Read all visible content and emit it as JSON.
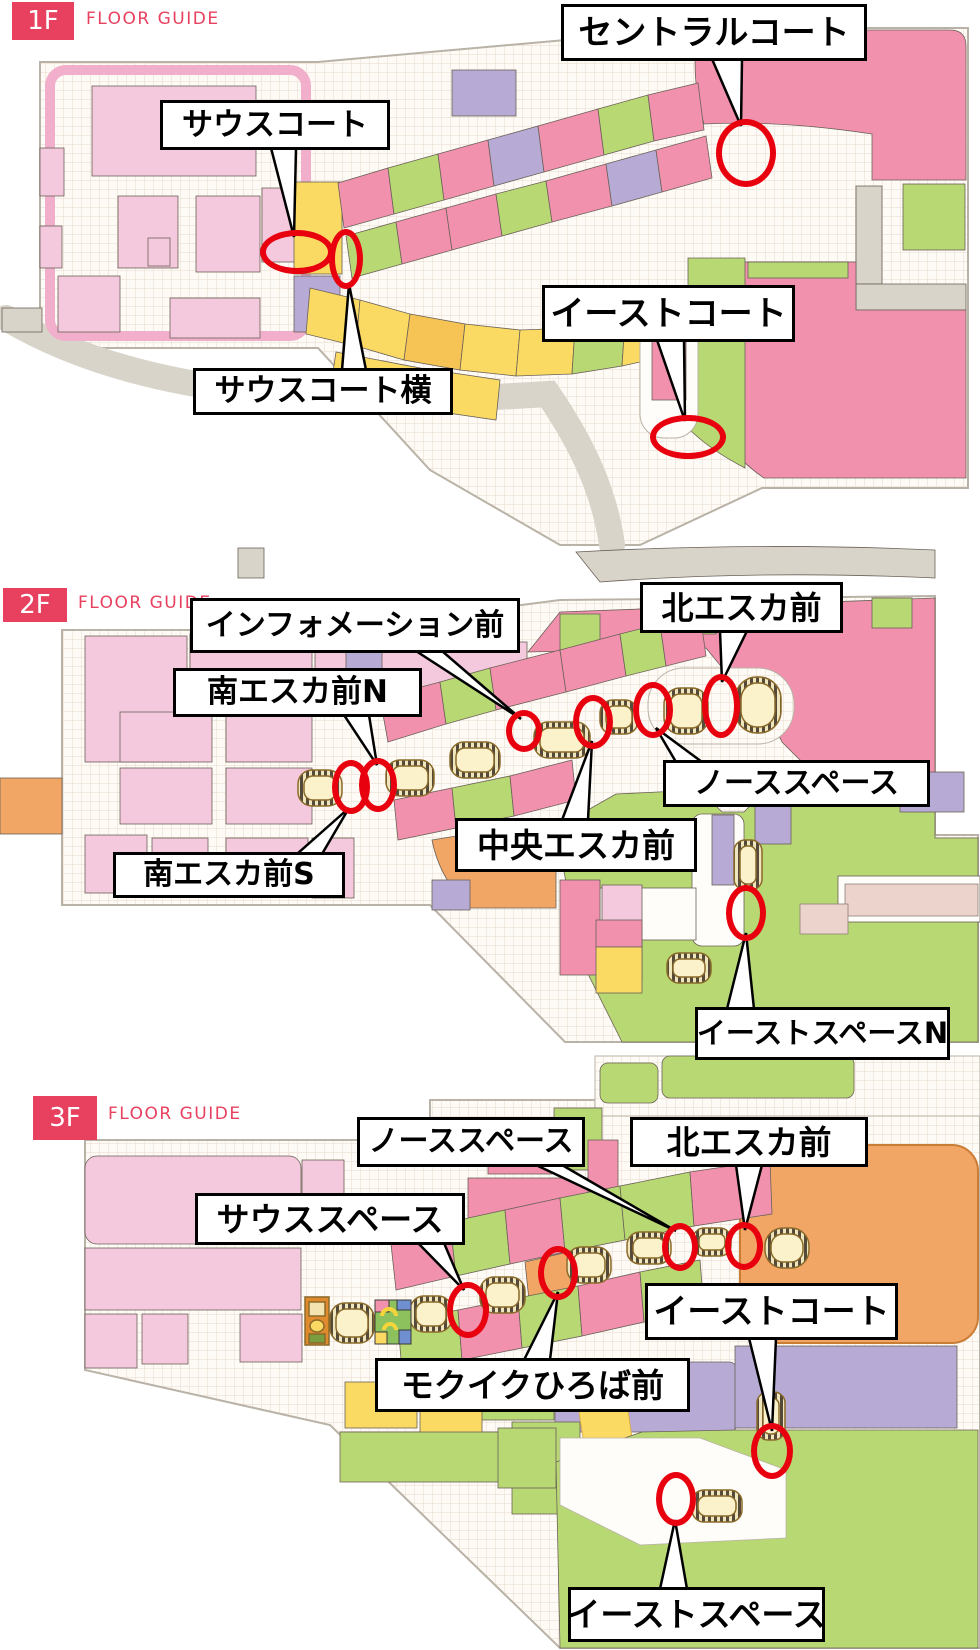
{
  "page": {
    "title": "FLOOR GUIDE"
  },
  "colors": {
    "badge_red": "#e8415f",
    "marker_red": "#e8000f",
    "shop_pink": "#f191ad",
    "light_pink": "#f4c9de",
    "shop_green": "#b8d873",
    "shop_yellow": "#fada62",
    "shop_orange": "#f2a666",
    "shop_purple": "#b7abd5",
    "escalator_cream": "#fbf2cc",
    "road_gray": "#d8d4c9"
  },
  "floors": [
    {
      "badge": "1F",
      "guide_label": "FLOOR GUIDE",
      "callouts": [
        {
          "id": "south-court",
          "label": "サウスコート"
        },
        {
          "id": "central-court",
          "label": "セントラルコート"
        },
        {
          "id": "east-court",
          "label": "イーストコート"
        },
        {
          "id": "south-court-side",
          "label": "サウスコート横"
        }
      ],
      "markers": [
        {
          "id": "south-court",
          "cx": 297,
          "cy": 252,
          "rx": 31,
          "ry": 16
        },
        {
          "id": "south-court-side",
          "cx": 346,
          "cy": 259,
          "rx": 11,
          "ry": 24
        },
        {
          "id": "central-court",
          "cx": 746,
          "cy": 153,
          "rx": 24,
          "ry": 28
        },
        {
          "id": "east-court",
          "cx": 688,
          "cy": 437,
          "rx": 32,
          "ry": 16
        }
      ]
    },
    {
      "badge": "2F",
      "guide_label": "FLOOR GUIDE",
      "callouts": [
        {
          "id": "information-front",
          "label": "インフォメーション前"
        },
        {
          "id": "north-esca-front",
          "label": "北エスカ前"
        },
        {
          "id": "south-esca-front-n",
          "label": "南エスカ前N"
        },
        {
          "id": "north-space",
          "label": "ノーススペース"
        },
        {
          "id": "central-esca-front",
          "label": "中央エスカ前"
        },
        {
          "id": "south-esca-front-s",
          "label": "南エスカ前S"
        },
        {
          "id": "east-space-n",
          "label": "イーストスペースN"
        }
      ],
      "markers": [
        {
          "id": "south-esca-front-s",
          "cx": 351,
          "cy": 787,
          "rx": 13,
          "ry": 21
        },
        {
          "id": "south-esca-front-n",
          "cx": 378,
          "cy": 785,
          "rx": 13,
          "ry": 21
        },
        {
          "id": "information-front",
          "cx": 524,
          "cy": 731,
          "rx": 12,
          "ry": 15
        },
        {
          "id": "central-esca-front",
          "cx": 593,
          "cy": 722,
          "rx": 14,
          "ry": 21
        },
        {
          "id": "north-space",
          "cx": 653,
          "cy": 710,
          "rx": 14,
          "ry": 22
        },
        {
          "id": "north-esca-front",
          "cx": 721,
          "cy": 706,
          "rx": 13,
          "ry": 26
        },
        {
          "id": "east-space-n",
          "cx": 746,
          "cy": 913,
          "rx": 14,
          "ry": 22
        }
      ]
    },
    {
      "badge": "3F",
      "guide_label": "FLOOR GUIDE",
      "callouts": [
        {
          "id": "north-space",
          "label": "ノーススペース"
        },
        {
          "id": "north-esca-front",
          "label": "北エスカ前"
        },
        {
          "id": "south-space",
          "label": "サウススペース"
        },
        {
          "id": "mokuiku-hiroba-front",
          "label": "モクイクひろば前"
        },
        {
          "id": "east-court",
          "label": "イーストコート"
        },
        {
          "id": "east-space",
          "label": "イーストスペース"
        }
      ],
      "markers": [
        {
          "id": "south-space",
          "cx": 468,
          "cy": 1310,
          "rx": 15,
          "ry": 22
        },
        {
          "id": "mokuiku-hiroba-front",
          "cx": 558,
          "cy": 1273,
          "rx": 14,
          "ry": 21
        },
        {
          "id": "north-space",
          "cx": 680,
          "cy": 1247,
          "rx": 12,
          "ry": 18
        },
        {
          "id": "north-esca-front",
          "cx": 744,
          "cy": 1246,
          "rx": 13,
          "ry": 18
        },
        {
          "id": "east-court",
          "cx": 772,
          "cy": 1451,
          "rx": 15,
          "ry": 22
        },
        {
          "id": "east-space",
          "cx": 676,
          "cy": 1499,
          "rx": 14,
          "ry": 21
        }
      ]
    }
  ]
}
